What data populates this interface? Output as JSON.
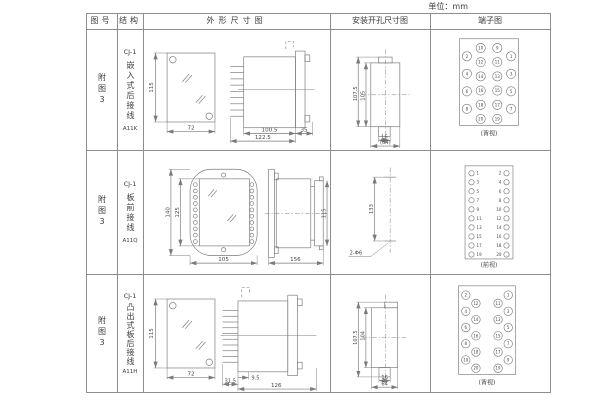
{
  "unit_label": "单位：mm",
  "table": {
    "headers": [
      "图号",
      "结构",
      "外形尺寸图",
      "安装开孔尺寸图",
      "端子图"
    ],
    "rows": [
      {
        "figure_no": "附图3",
        "structure": {
          "model": "CJ-1",
          "mount": "嵌入式后接线",
          "code": "A11K"
        },
        "outline": {
          "front_height": "115",
          "front_width": "72",
          "body_len": "100.5",
          "total_len": "122.5",
          "flange": "35"
        },
        "install": {
          "outer_h": "107.5",
          "inner_h": "105",
          "tab_w": "16",
          "total_w": "(64)"
        },
        "terminal": {
          "view_label": "(背视)",
          "style": "rear-quad",
          "columns": {
            "outer_left": [
              "2",
              "4",
              "6",
              "8"
            ],
            "inner_left": [
              "10",
              "12",
              "14",
              "16",
              "18",
              "20"
            ],
            "inner_right": [
              "9",
              "11",
              "13",
              "15",
              "17",
              "19"
            ],
            "outer_right": [
              "1",
              "3",
              "5",
              "7"
            ]
          }
        }
      },
      {
        "figure_no": "附图3",
        "structure": {
          "model": "CJ-1",
          "mount": "板前接线",
          "code": "A11Q"
        },
        "outline": {
          "front_height_outer": "140",
          "front_height_inner": "125",
          "front_width": "105",
          "side_length": "156",
          "side_height": "115"
        },
        "install": {
          "hole_pitch": "133",
          "hole_label": "2-Φ6"
        },
        "terminal": {
          "view_label": "(前视)",
          "style": "front-pairs",
          "pairs": [
            [
              "1",
              "2"
            ],
            [
              "3",
              "4"
            ],
            [
              "5",
              "6"
            ],
            [
              "7",
              "8"
            ],
            [
              "9",
              "10"
            ],
            [
              "11",
              "12"
            ],
            [
              "13",
              "14"
            ],
            [
              "15",
              "16"
            ],
            [
              "17",
              "18"
            ],
            [
              "19",
              "20"
            ]
          ]
        }
      },
      {
        "figure_no": "附图3",
        "structure": {
          "model": "CJ-1",
          "mount": "凸出式板后接线",
          "code": "A11H"
        },
        "outline": {
          "front_height": "115",
          "front_width": "72",
          "dim_a": "9.5",
          "dim_b": "31.5",
          "dim_c": "126"
        },
        "install": {
          "outer_h": "107.5",
          "inner_h": "104",
          "tab_w": "16",
          "total_w": "64"
        },
        "terminal": {
          "view_label": "(背视)",
          "style": "rear-clusters",
          "columns": {
            "outer_left": [
              "2",
              "4",
              "6",
              "8",
              "10"
            ],
            "inner_left": [
              "12",
              "14",
              "16",
              "18",
              "20"
            ],
            "inner_right": [
              "11",
              "13",
              "15",
              "17",
              "19"
            ],
            "outer_right": [
              "1",
              "3",
              "5",
              "7",
              "9"
            ]
          }
        }
      }
    ]
  },
  "colors": {
    "line": "#7a7a7a",
    "text": "#474747",
    "border": "#8d8d8d"
  }
}
